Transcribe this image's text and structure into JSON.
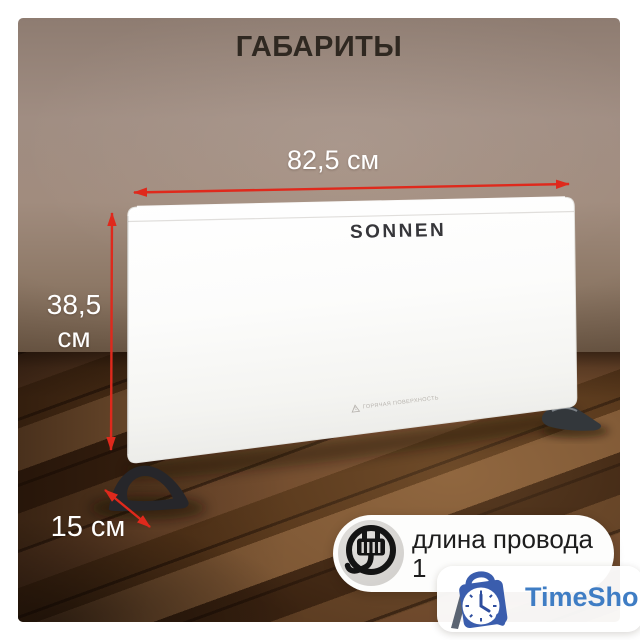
{
  "title": "ГАБАРИТЫ",
  "product": {
    "brand": "SONNEN",
    "warning_label": "ГОРЯЧАЯ ПОВЕРХНОСТЬ"
  },
  "dimensions": {
    "width": "82,5 см",
    "height_value": "38,5",
    "height_unit": "см",
    "depth": "15 см"
  },
  "badge": {
    "icon": "power-plug-icon",
    "line1": "длина провода",
    "line2": "1"
  },
  "watermark": {
    "icon": "timeshop-bag-clock-icon",
    "text": "TimeShop"
  },
  "colors": {
    "arrow_red": "#df291c",
    "title_text": "#2f2821",
    "dimension_text": "#ffffff",
    "badge_text": "#1d1d1d",
    "watermark_blue": "#3f7dc4",
    "wall": "#9c887b",
    "floor": "#57371e",
    "panel_white": "#fbfbfa"
  }
}
